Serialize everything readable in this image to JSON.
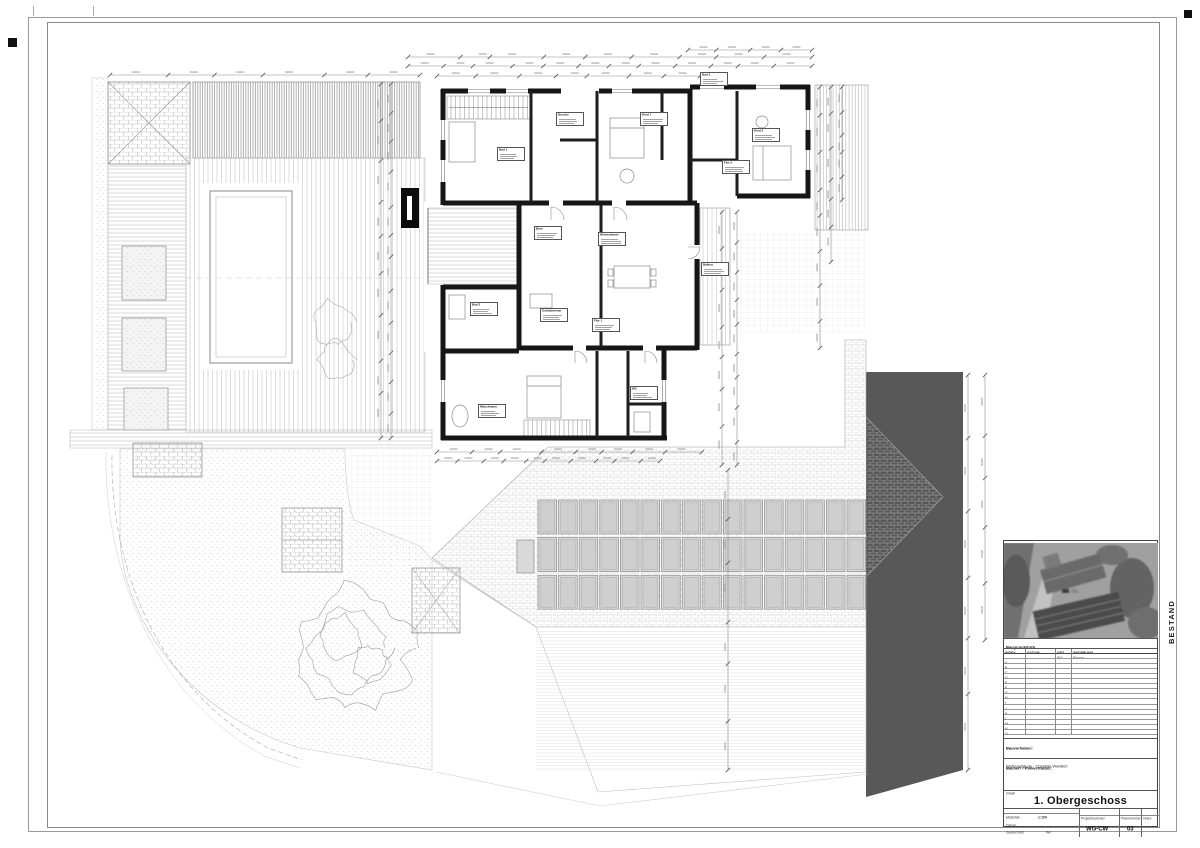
{
  "sheet": {
    "status_label": "BESTAND"
  },
  "plan": {
    "rooms": [
      {
        "name": "Bad 3"
      },
      {
        "name": "Dusche"
      },
      {
        "name": "Kind 1"
      },
      {
        "name": "Kind 2"
      },
      {
        "name": "Flur 2"
      },
      {
        "name": "Bad 1"
      },
      {
        "name": "Büro"
      },
      {
        "name": "Wohnzimmer"
      },
      {
        "name": "Balkon"
      },
      {
        "name": "Schlafzimmer"
      },
      {
        "name": "Bad 2"
      },
      {
        "name": "Flur 1"
      },
      {
        "name": "WC"
      },
      {
        "name": "Waschraum"
      }
    ]
  },
  "title_block": {
    "plot_label": "Baugrundstück",
    "revision_table": {
      "headers": [
        "INDEX",
        "DATUM",
        "GEZ.",
        "ÄNDERUNG"
      ],
      "first_entry": {
        "gez": "WJ",
        "text": "Einzug"
      },
      "index_letters": [
        "A",
        "B",
        "C",
        "D",
        "E",
        "F",
        "G",
        "H",
        "I",
        "J",
        "K",
        "L",
        "M",
        "N",
        "O"
      ]
    },
    "project": {
      "label": "Bauvorhaben:",
      "value": "Wohngebäude · Christian Weidlich"
    },
    "owner": {
      "label": "Bauherr / Planverfasser:"
    },
    "content": {
      "label": "Inhalt",
      "title": "1. Obergeschoss"
    },
    "meta": {
      "scale_label": "Maßstab",
      "scale_value": "1:100",
      "date_label": "Datum",
      "drawn_label": "Gezeichnet",
      "drawn_value": "WJ",
      "project_no_label": "Projektnummer",
      "project_no": "WG-CW",
      "plan_no_label": "Plannummer",
      "plan_no": "03",
      "index_label": "Index"
    }
  }
}
